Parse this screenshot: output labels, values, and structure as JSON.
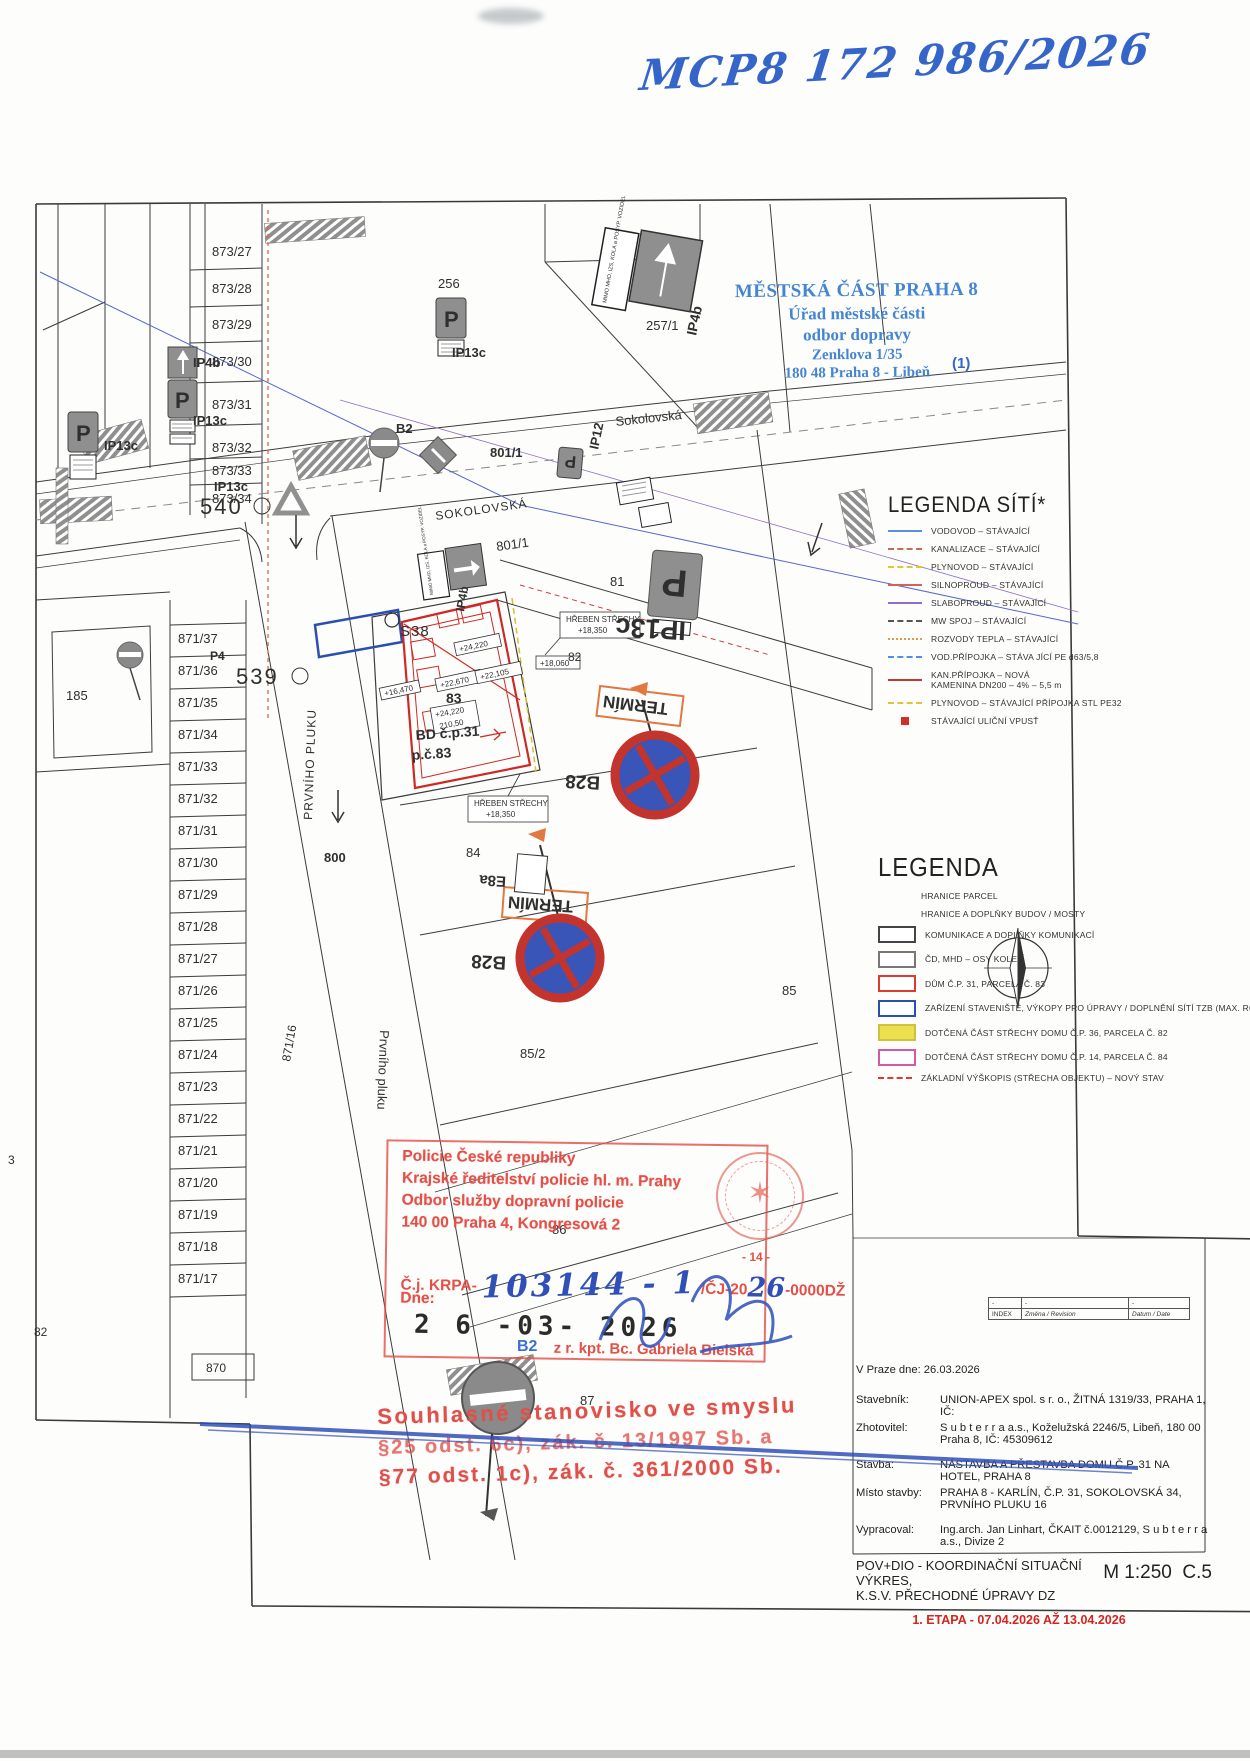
{
  "handwritten_ref": "MCP8 172 986/2026",
  "authority_stamp": {
    "line1": "MĚSTSKÁ ČÁST PRAHA 8",
    "line2": "Úřad městské části",
    "line3": "odbor dopravy",
    "line4": "Zenklova 1/35",
    "line5": "180 48 Praha 8 - Libeň",
    "page_note": "(1)"
  },
  "legend_networks": {
    "title": "LEGENDA SÍTÍ*",
    "items": [
      {
        "label": "VODOVOD – STÁVAJÍCÍ",
        "color": "#5b8ee0",
        "dash": "solid"
      },
      {
        "label": "KANALIZACE – STÁVAJÍCÍ",
        "color": "#c46a5a",
        "dash": "dashed"
      },
      {
        "label": "PLYNOVOD – STÁVAJÍCÍ",
        "color": "#e2c43c",
        "dash": "dashed"
      },
      {
        "label": "SILNOPROUD – STÁVAJÍCÍ",
        "color": "#d4625a",
        "dash": "solid"
      },
      {
        "label": "SLABOPROUD – STÁVAJÍCÍ",
        "color": "#8f6ec8",
        "dash": "solid"
      },
      {
        "label": "MW SPOJ – STÁVAJÍCÍ",
        "color": "#555555",
        "dash": "dashed"
      },
      {
        "label": "ROZVODY TEPLA – STÁVAJÍCÍ",
        "color": "#e09a4e",
        "dash": "dotted"
      },
      {
        "label": "VOD.PŘÍPOJKA – STÁVA JÍCÍ PE d63/5,8",
        "color": "#4f8fe8",
        "dash": "dashed"
      },
      {
        "label": "KAN.PŘÍPOJKA – NOVÁ",
        "sub": "KAMENINA DN200 – 4% – 5,5 m",
        "color": "#c03a30",
        "dash": "solid"
      },
      {
        "label": "PLYNOVOD – STÁVAJÍCÍ PŘÍPOJKA STL PE32",
        "color": "#e2c43c",
        "dash": "dashed"
      },
      {
        "label": "STÁVAJÍCÍ ULIČNÍ VPUSŤ",
        "color": "#d03028",
        "dash": "square"
      }
    ]
  },
  "legend_main": {
    "title": "LEGENDA",
    "items": [
      {
        "label": "HRANICE PARCEL",
        "swatch": "none"
      },
      {
        "label": "HRANICE A DOPLŇKY BUDOV / MOSTY",
        "swatch": "none"
      },
      {
        "label": "KOMUNIKACE A DOPLŇKY KOMUNIKACÍ",
        "swatch": "box",
        "border": "#444444",
        "fill": "#ffffff"
      },
      {
        "label": "ČD, MHD – OSY KOLEJÍ",
        "swatch": "box",
        "border": "#777777",
        "fill": "#ffffff"
      },
      {
        "label": "DŮM Č.P. 31, PARCELA Č. 83",
        "swatch": "box",
        "border": "#e03a30",
        "fill": "#ffffff"
      },
      {
        "label": "ZAŘÍZENÍ STAVENIŠTĚ, VÝKOPY PRO ÚPRAVY / DOPLNĚNÍ SÍTÍ TZB (MAX. ROZSAH)",
        "swatch": "box",
        "border": "#2b4fae",
        "fill": "#ffffff"
      },
      {
        "label": "DOTČENÁ ČÁST STŘECHY DOMU Č.P. 36, PARCELA Č. 82",
        "swatch": "box",
        "border": "#cfc23e",
        "fill": "#ece04f"
      },
      {
        "label": "DOTČENÁ ČÁST STŘECHY DOMU Č.P. 14, PARCELA Č. 84",
        "swatch": "box",
        "border": "#d65aa0",
        "fill": "#ffffff"
      },
      {
        "label": "ZÁKLADNÍ VÝŠKOPIS (STŘECHA OBJEKTU) – NOVÝ STAV",
        "swatch": "dashline",
        "border": "#e03a30",
        "fill": "#e03a30"
      }
    ]
  },
  "index_table": {
    "dash": "-",
    "index": "INDEX",
    "change": "Změna / Revision",
    "date": "Datum / Date"
  },
  "info_block": {
    "date_line": "V Praze dne: 26.03.2026",
    "rows": [
      {
        "label": "Stavebník:",
        "value": "UNION-APEX spol. s r. o., ŽITNÁ 1319/33, PRAHA 1, IČ:"
      },
      {
        "label": "Zhotovitel:",
        "value": "S u b t e r r a a.s., Koželužská 2246/5, Libeň, 180 00 Praha 8, IČ: 45309612"
      },
      {
        "label": "Stavba:",
        "value": "NÁSTAVBA A PŘESTAVBA DOMU Č.P. 31 NA HOTEL, PRAHA 8"
      },
      {
        "label": "Místo stavby:",
        "value": "PRAHA 8 - KARLÍN, Č.P. 31, SOKOLOVSKÁ 34, PRVNÍHO PLUKU 16"
      },
      {
        "label": "Vypracoval:",
        "value": "Ing.arch. Jan Linhart, ČKAIT č.0012129, S u b t e r r a a.s., Divize 2"
      }
    ],
    "title_line1": "POV+DIO - KOORDINAČNÍ SITUAČNÍ VÝKRES,",
    "title_line2": "K.S.V. PŘECHODNÉ ÚPRAVY DZ",
    "scale": "M 1:250",
    "sheet": "C.5",
    "stage_line": "1. ETAPA - 07.04.2026 AŽ 13.04.2026"
  },
  "police_stamp": {
    "line1": "Policie České republiky",
    "line2": "Krajské ředitelství policie hl. m. Prahy",
    "line3": "Odbor služby dopravní policie",
    "line4": "140 00 Praha 4, Kongresová 2",
    "cj_label": "Č.j. KRPA-",
    "cj_handwritten": "103144 - 1",
    "cj_suffix1": "/ČJ-20",
    "cj_handwritten2": "26",
    "cj_suffix2": "-0000DŽ",
    "dne_label": "Dne:",
    "date_stamp": "2 6 -03- 2026",
    "signature": "z r. kpt. Bc. Gabriela Bielská",
    "page_mark": "- 14 -",
    "emblem_star": "✶"
  },
  "approval_stamp": {
    "line1": "Souhlasné stanovisko ve smyslu",
    "line2": "§25 odst. 6c), zák. č. 13/1997 Sb. a",
    "line3": "§77 odst. 1c), zák. č. 361/2000 Sb."
  },
  "map": {
    "street_names": {
      "sokolovska_caps": "SOKOLOVSKÁ",
      "sokolovska": "Sokolovská",
      "prvniho_pluku_caps": "PRVNÍHO PLUKU",
      "prvniho_pluku": "Prvního pluku"
    },
    "parcels_top": [
      "873/27",
      "873/28",
      "873/29",
      "873/30",
      "873/31",
      "873/32",
      "873/33",
      "873/34"
    ],
    "parcels_left": [
      "871/37",
      "871/36",
      "871/35",
      "871/34",
      "871/33",
      "871/32",
      "871/31",
      "871/30",
      "871/29",
      "871/28",
      "871/27",
      "871/26",
      "871/25",
      "871/24",
      "871/23",
      "871/22",
      "871/21",
      "871/20",
      "871/19",
      "871/18",
      "871/17"
    ],
    "parcels_misc": {
      "p256": "256",
      "p257": "257/1",
      "p801": "801/1",
      "p81": "81",
      "p82": "82",
      "p83": "83",
      "p84": "84",
      "p85": "85",
      "p85_2": "85/2",
      "p86": "86",
      "p87": "87",
      "p185": "185",
      "p800": "800",
      "p870": "870",
      "p871_16": "871/16",
      "p82_edge": "82",
      "p3": "3"
    },
    "point_labels": {
      "s38": "S38",
      "n540": "540",
      "n539": "539"
    },
    "building": {
      "label1": "BD č.p.31",
      "label2": "p.č.83"
    },
    "signs": {
      "ip13c": "IP13c",
      "ip4b": "IP4b",
      "ip12": "IP12",
      "p4": "P4",
      "b2": "B2",
      "b28": "B28",
      "e8a": "E8a",
      "termin": "TERMÍN",
      "p_letter": "P",
      "arrow_plate": "MIMO MHD, IZS, KOLA a POSYP. VOZIDEL"
    },
    "elevations": {
      "ridge": "HŘEBEN STŘECHY",
      "e18350": "+18,350",
      "e18060": "+18,060",
      "e24220": "+24,220",
      "e22670": "+22,670",
      "e22105": "+22,105",
      "e21050": "210,50",
      "e16470": "+16,470"
    }
  },
  "colors": {
    "stamp_blue": "#3b7fd0",
    "pen_blue": "#3565c8",
    "stamp_red": "#e25048",
    "map_red": "#cc2a26",
    "sign_blue": "#3a6fd8",
    "sign_gray": "#8f8f8f",
    "b28_blue": "#3a55b8",
    "termin_orange": "#e07840",
    "plan_yellow": "#d8c030"
  }
}
